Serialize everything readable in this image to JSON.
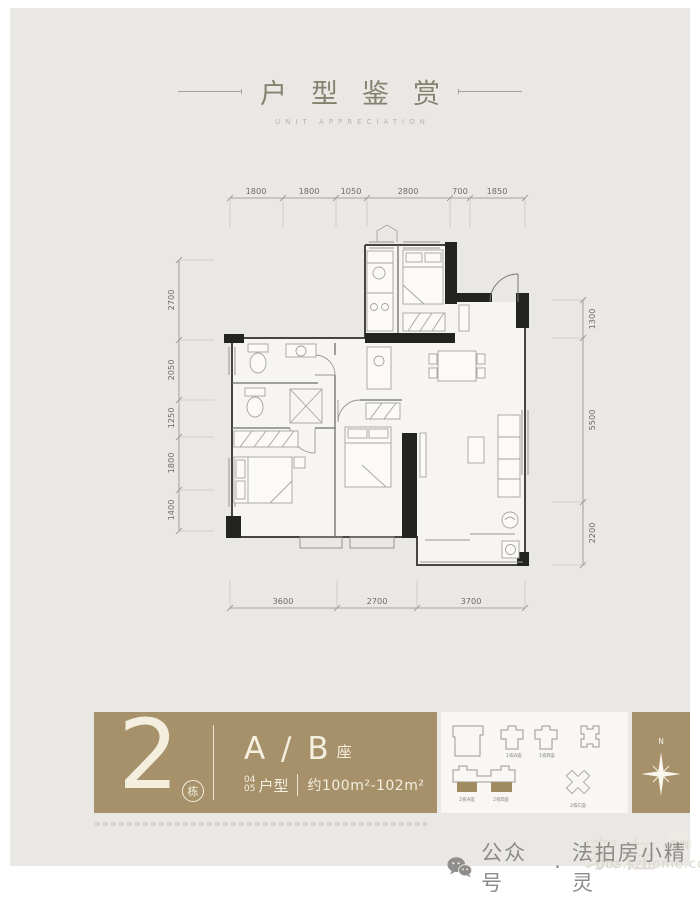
{
  "header": {
    "title": "户型鉴赏",
    "subtitle": "UNIT APPRECIATION"
  },
  "floor_plan": {
    "dims_top": [
      "1800",
      "1800",
      "1050",
      "2800",
      "700",
      "1850"
    ],
    "dims_left": [
      "2700",
      "2050",
      "1250",
      "1800",
      "1400"
    ],
    "dims_right": [
      "1300",
      "5500",
      "2200"
    ],
    "dims_bottom": [
      "3600",
      "2700",
      "3700"
    ]
  },
  "info_band": {
    "building_number": "2",
    "building_suffix": "栋",
    "block_name": "A / B",
    "block_suffix": "座",
    "unit_no_top": "04",
    "unit_no_bottom": "05",
    "unit_type_label": "户型",
    "area_range": "约100m²-102m²",
    "band_color": "#a6916b"
  },
  "site_plan": {
    "labels": [
      "1栋A座",
      "1栋B座",
      "2栋A座",
      "2栋B座",
      "2栋C座"
    ],
    "highlight_color": "#a08c60"
  },
  "compass": {
    "north_label": "N"
  },
  "footer": {
    "caption_prefix": "公众号",
    "caption_sep": "·",
    "caption_name": "法拍房小精灵",
    "watermark_name": "家在",
    "watermark_badge": "深圳",
    "watermark_site": "bbs.szhome.com"
  }
}
